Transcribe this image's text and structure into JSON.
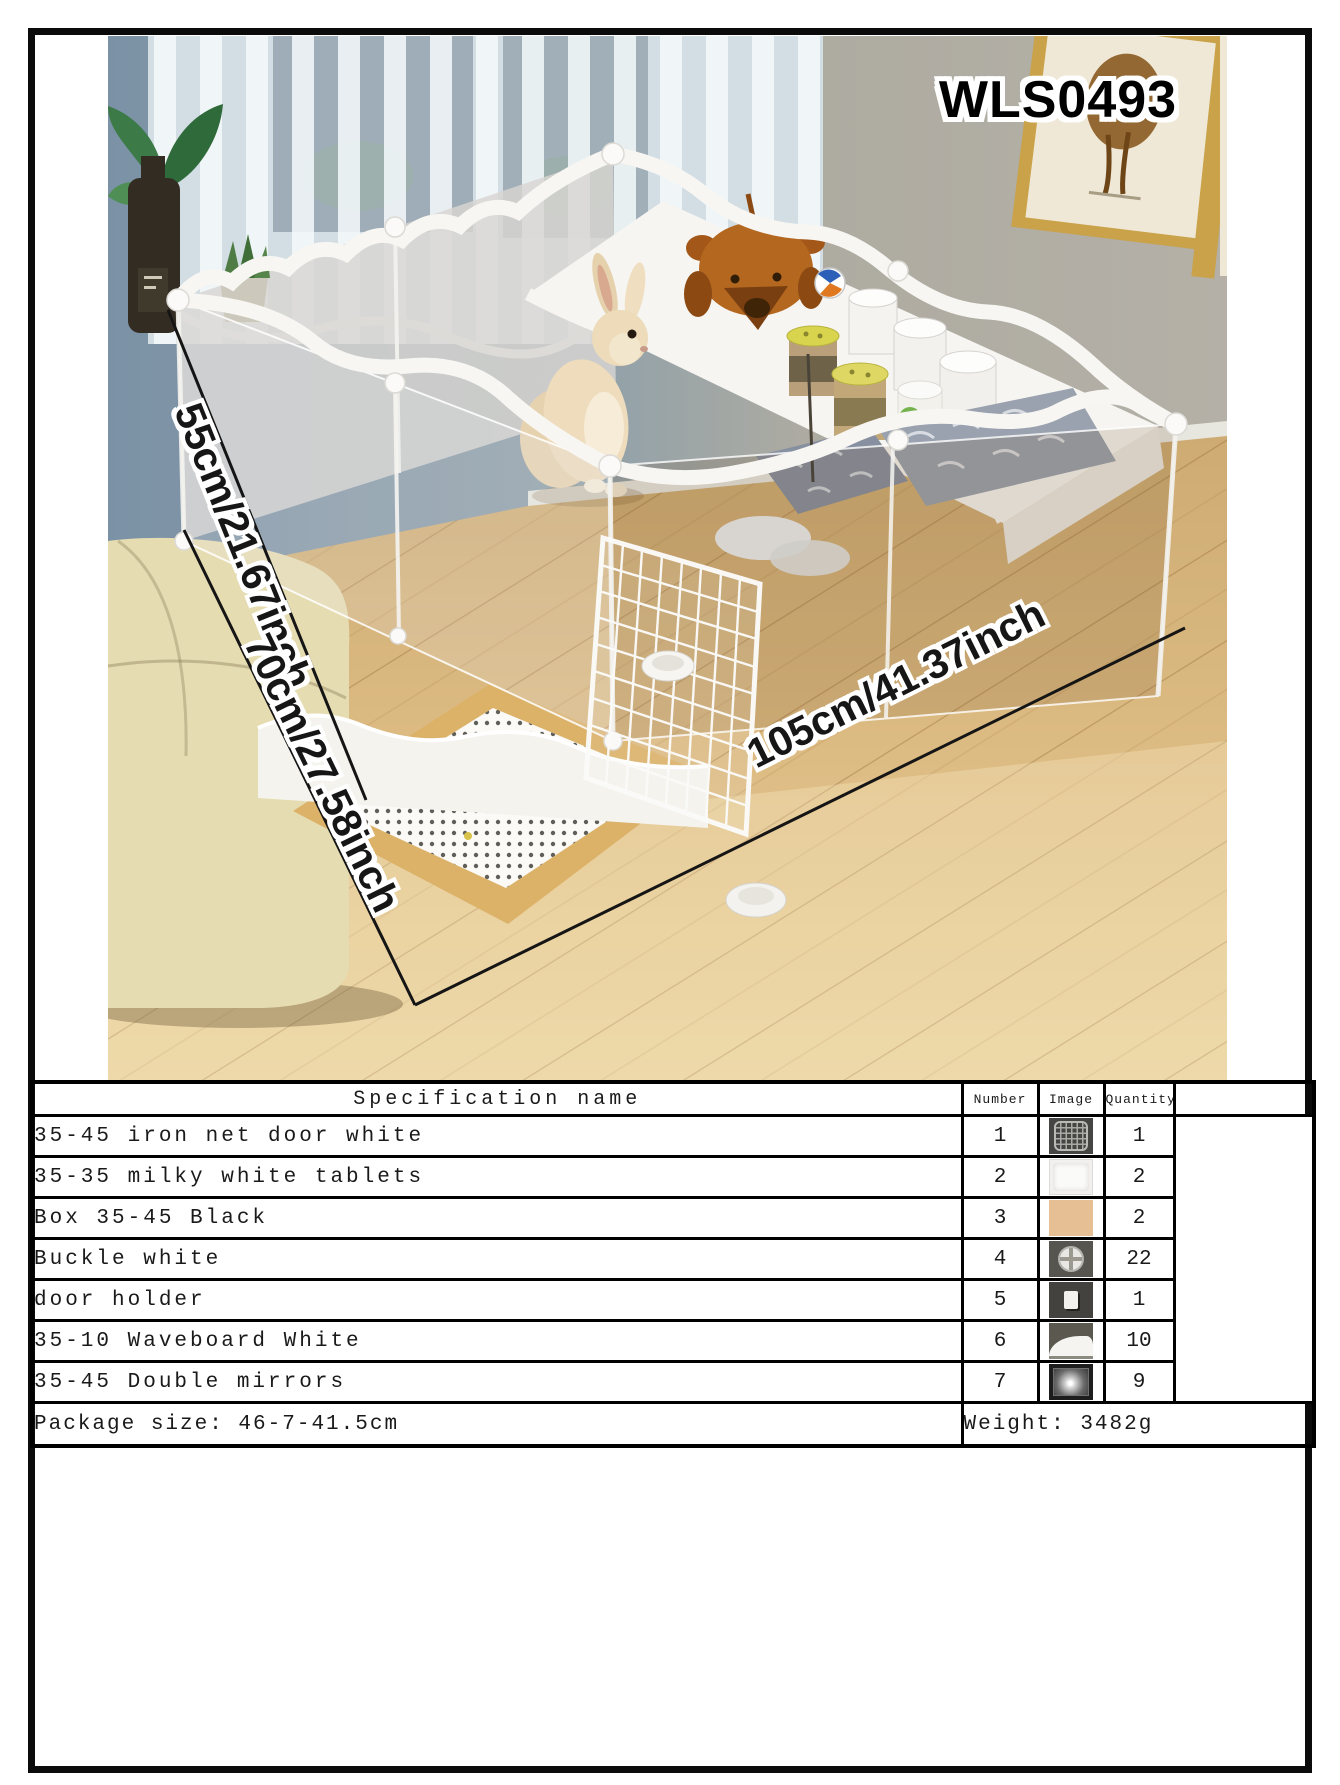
{
  "product": {
    "code": "WLS0493"
  },
  "photo": {
    "dimension_labels": {
      "height": "55cm/21.67inch",
      "depth": "70cm/27.58inch",
      "width": "105cm/41.37inch"
    },
    "colors": {
      "wall_left": "#7b92a6",
      "wall_right": "#b2aea5",
      "floor": "#dcba82",
      "panel_white": "#f6f5f1"
    }
  },
  "spec_table": {
    "headers": {
      "name": "Specification name",
      "number": "Number",
      "image": "Image",
      "quantity": "Quantity"
    },
    "rows": [
      {
        "name": "35-45 iron net door white",
        "number": "1",
        "image_icon": "iron-net-door-thumbnail",
        "quantity": "1"
      },
      {
        "name": "35-35 milky white tablets",
        "number": "2",
        "image_icon": "milky-white-tablet-thumbnail",
        "quantity": "2"
      },
      {
        "name": "Box 35-45 Black",
        "number": "3",
        "image_icon": "black-box-thumbnail",
        "quantity": "2"
      },
      {
        "name": "Buckle white",
        "number": "4",
        "image_icon": "white-buckle-thumbnail",
        "quantity": "22"
      },
      {
        "name": "door holder",
        "number": "5",
        "image_icon": "door-holder-thumbnail",
        "quantity": "1"
      },
      {
        "name": "35-10 Waveboard White",
        "number": "6",
        "image_icon": "waveboard-thumbnail",
        "quantity": "10"
      },
      {
        "name": "35-45 Double mirrors",
        "number": "7",
        "image_icon": "double-mirror-thumbnail",
        "quantity": "9"
      }
    ],
    "footer": {
      "package_size": "Package size: 46-7-41.5cm",
      "weight": "Weight: 3482g"
    }
  }
}
